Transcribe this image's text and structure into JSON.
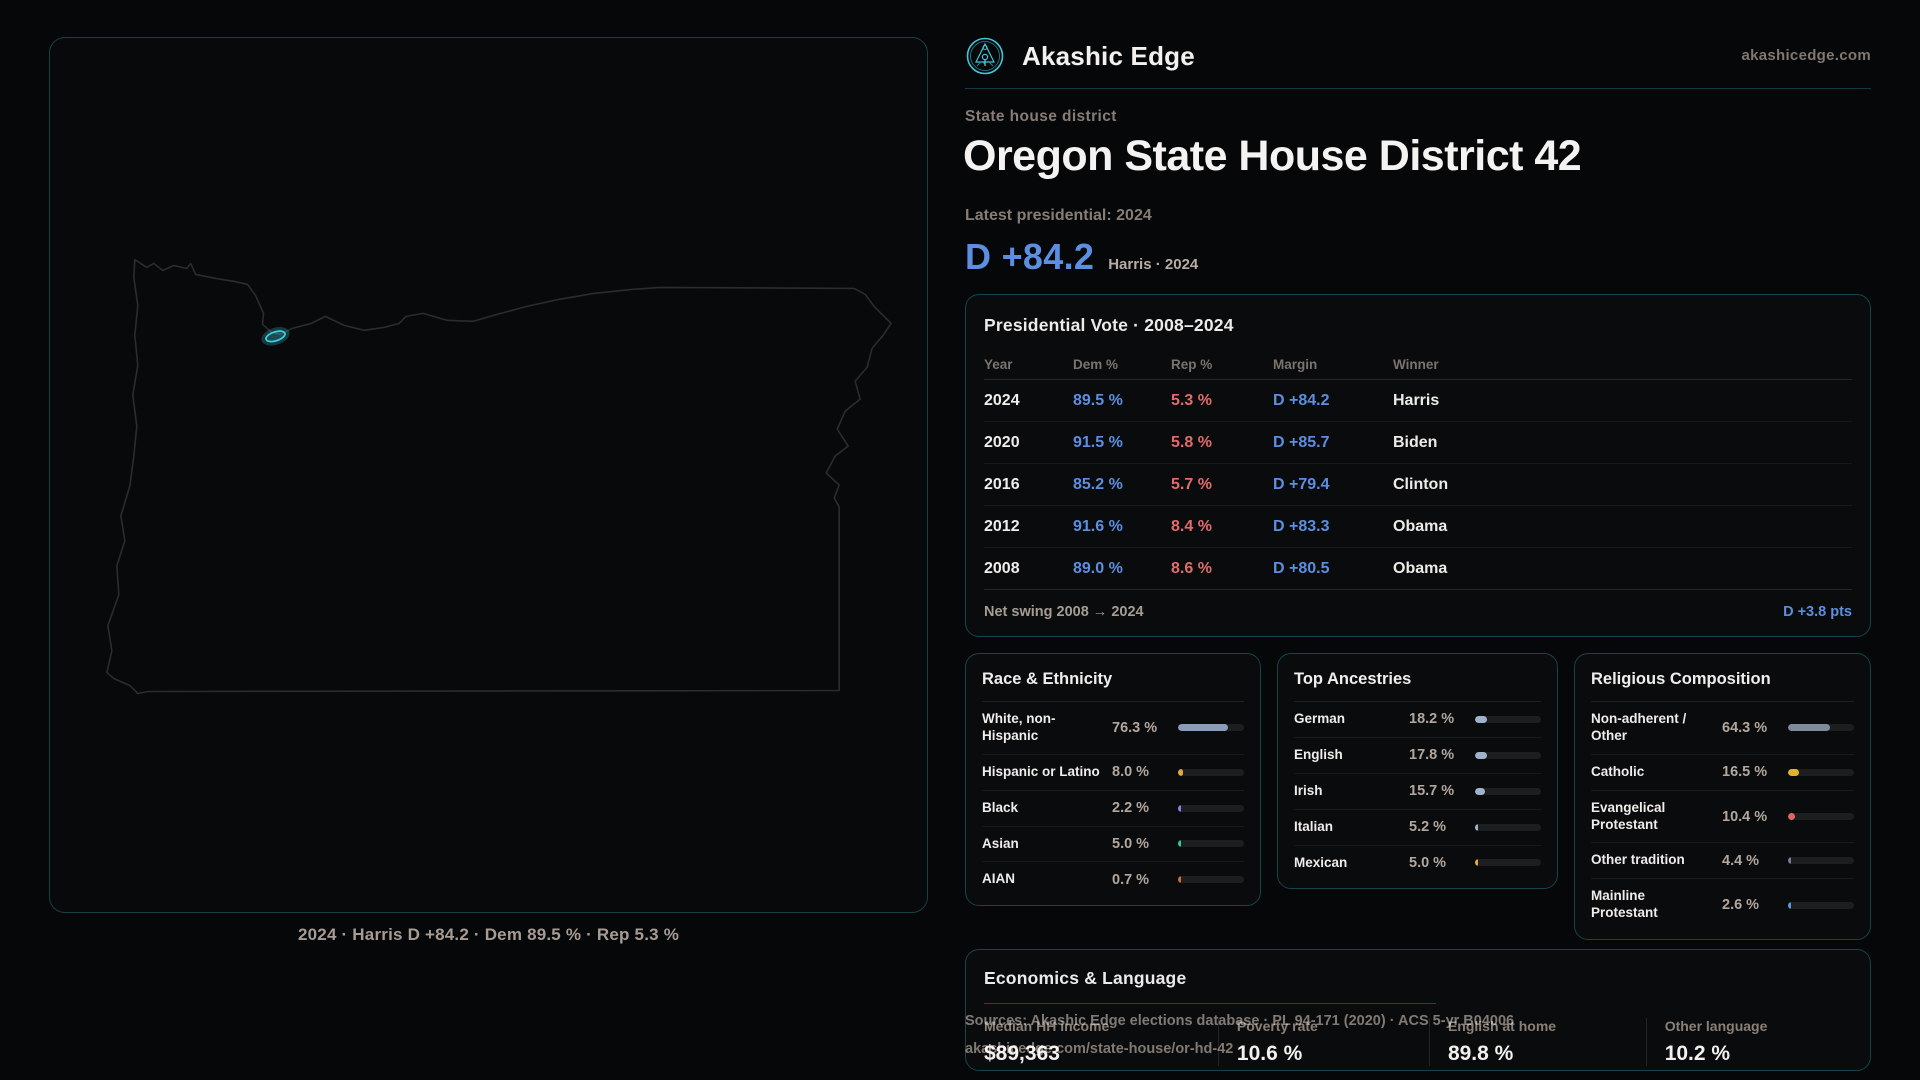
{
  "brand": {
    "name": "Akashic Edge",
    "domain": "akashicedge.com",
    "accent": "#3fc6d8"
  },
  "map": {
    "caption": "2024 · Harris D +84.2 · Dem 89.5 % · Rep 5.3 %"
  },
  "header": {
    "kicker": "State house district",
    "title": "Oregon State House District 42",
    "latest_label": "Latest presidential: 2024",
    "margin_value": "D +84.2",
    "margin_context": "Harris · 2024",
    "margin_color": "#5c8ee1"
  },
  "presidential": {
    "title": "Presidential Vote · 2008–2024",
    "columns": [
      "Year",
      "Dem %",
      "Rep %",
      "Margin",
      "Winner"
    ],
    "rows": [
      {
        "year": "2024",
        "dem": "89.5 %",
        "rep": "5.3 %",
        "margin": "D +84.2",
        "winner": "Harris"
      },
      {
        "year": "2020",
        "dem": "91.5 %",
        "rep": "5.8 %",
        "margin": "D +85.7",
        "winner": "Biden"
      },
      {
        "year": "2016",
        "dem": "85.2 %",
        "rep": "5.7 %",
        "margin": "D +79.4",
        "winner": "Clinton"
      },
      {
        "year": "2012",
        "dem": "91.6 %",
        "rep": "8.4 %",
        "margin": "D +83.3",
        "winner": "Obama"
      },
      {
        "year": "2008",
        "dem": "89.0 %",
        "rep": "8.6 %",
        "margin": "D +80.5",
        "winner": "Obama"
      }
    ],
    "net_swing_label": "Net swing 2008 → 2024",
    "net_swing_value": "D +3.8 pts",
    "dem_color": "#5c8ee1",
    "rep_color": "#e26b6b"
  },
  "race": {
    "title": "Race & Ethnicity",
    "rows": [
      {
        "label": "White, non-Hispanic",
        "value": "76.3 %",
        "pct": 76.3,
        "color": "#8b9cb8"
      },
      {
        "label": "Hispanic or Latino",
        "value": "8.0 %",
        "pct": 8.0,
        "color": "#e3a93c"
      },
      {
        "label": "Black",
        "value": "2.2 %",
        "pct": 2.2,
        "color": "#8f7ee8"
      },
      {
        "label": "Asian",
        "value": "5.0 %",
        "pct": 5.0,
        "color": "#37c98e"
      },
      {
        "label": "AIAN",
        "value": "0.7 %",
        "pct": 0.7,
        "color": "#c9722e"
      }
    ]
  },
  "ancestries": {
    "title": "Top Ancestries",
    "rows": [
      {
        "label": "German",
        "value": "18.2 %",
        "pct": 18.2,
        "color": "#9db3c9"
      },
      {
        "label": "English",
        "value": "17.8 %",
        "pct": 17.8,
        "color": "#9db3c9"
      },
      {
        "label": "Irish",
        "value": "15.7 %",
        "pct": 15.7,
        "color": "#9db3c9"
      },
      {
        "label": "Italian",
        "value": "5.2 %",
        "pct": 5.2,
        "color": "#9db3c9"
      },
      {
        "label": "Mexican",
        "value": "5.0 %",
        "pct": 5.0,
        "color": "#e3a93c"
      }
    ]
  },
  "religion": {
    "title": "Religious Composition",
    "rows": [
      {
        "label": "Non-adherent / Other",
        "value": "64.3 %",
        "pct": 64.3,
        "color": "#7e8a9a"
      },
      {
        "label": "Catholic",
        "value": "16.5 %",
        "pct": 16.5,
        "color": "#e0b32f"
      },
      {
        "label": "Evangelical Protestant",
        "value": "10.4 %",
        "pct": 10.4,
        "color": "#e06565"
      },
      {
        "label": "Other tradition",
        "value": "4.4 %",
        "pct": 4.4,
        "color": "#76808c"
      },
      {
        "label": "Mainline Protestant",
        "value": "2.6 %",
        "pct": 2.6,
        "color": "#5b9bd5"
      }
    ]
  },
  "economics": {
    "title": "Economics & Language",
    "stats": [
      {
        "label": "Median HH income",
        "value": "$89,363"
      },
      {
        "label": "Poverty rate",
        "value": "10.6 %"
      },
      {
        "label": "English at home",
        "value": "89.8 %"
      },
      {
        "label": "Other language",
        "value": "10.2 %"
      }
    ]
  },
  "footer": {
    "sources_line": "Sources: Akashic Edge elections database · PL 94-171 (2020) · ACS 5-yr B04006",
    "permalink": "akashicedge.com/state-house/or-hd-42"
  }
}
